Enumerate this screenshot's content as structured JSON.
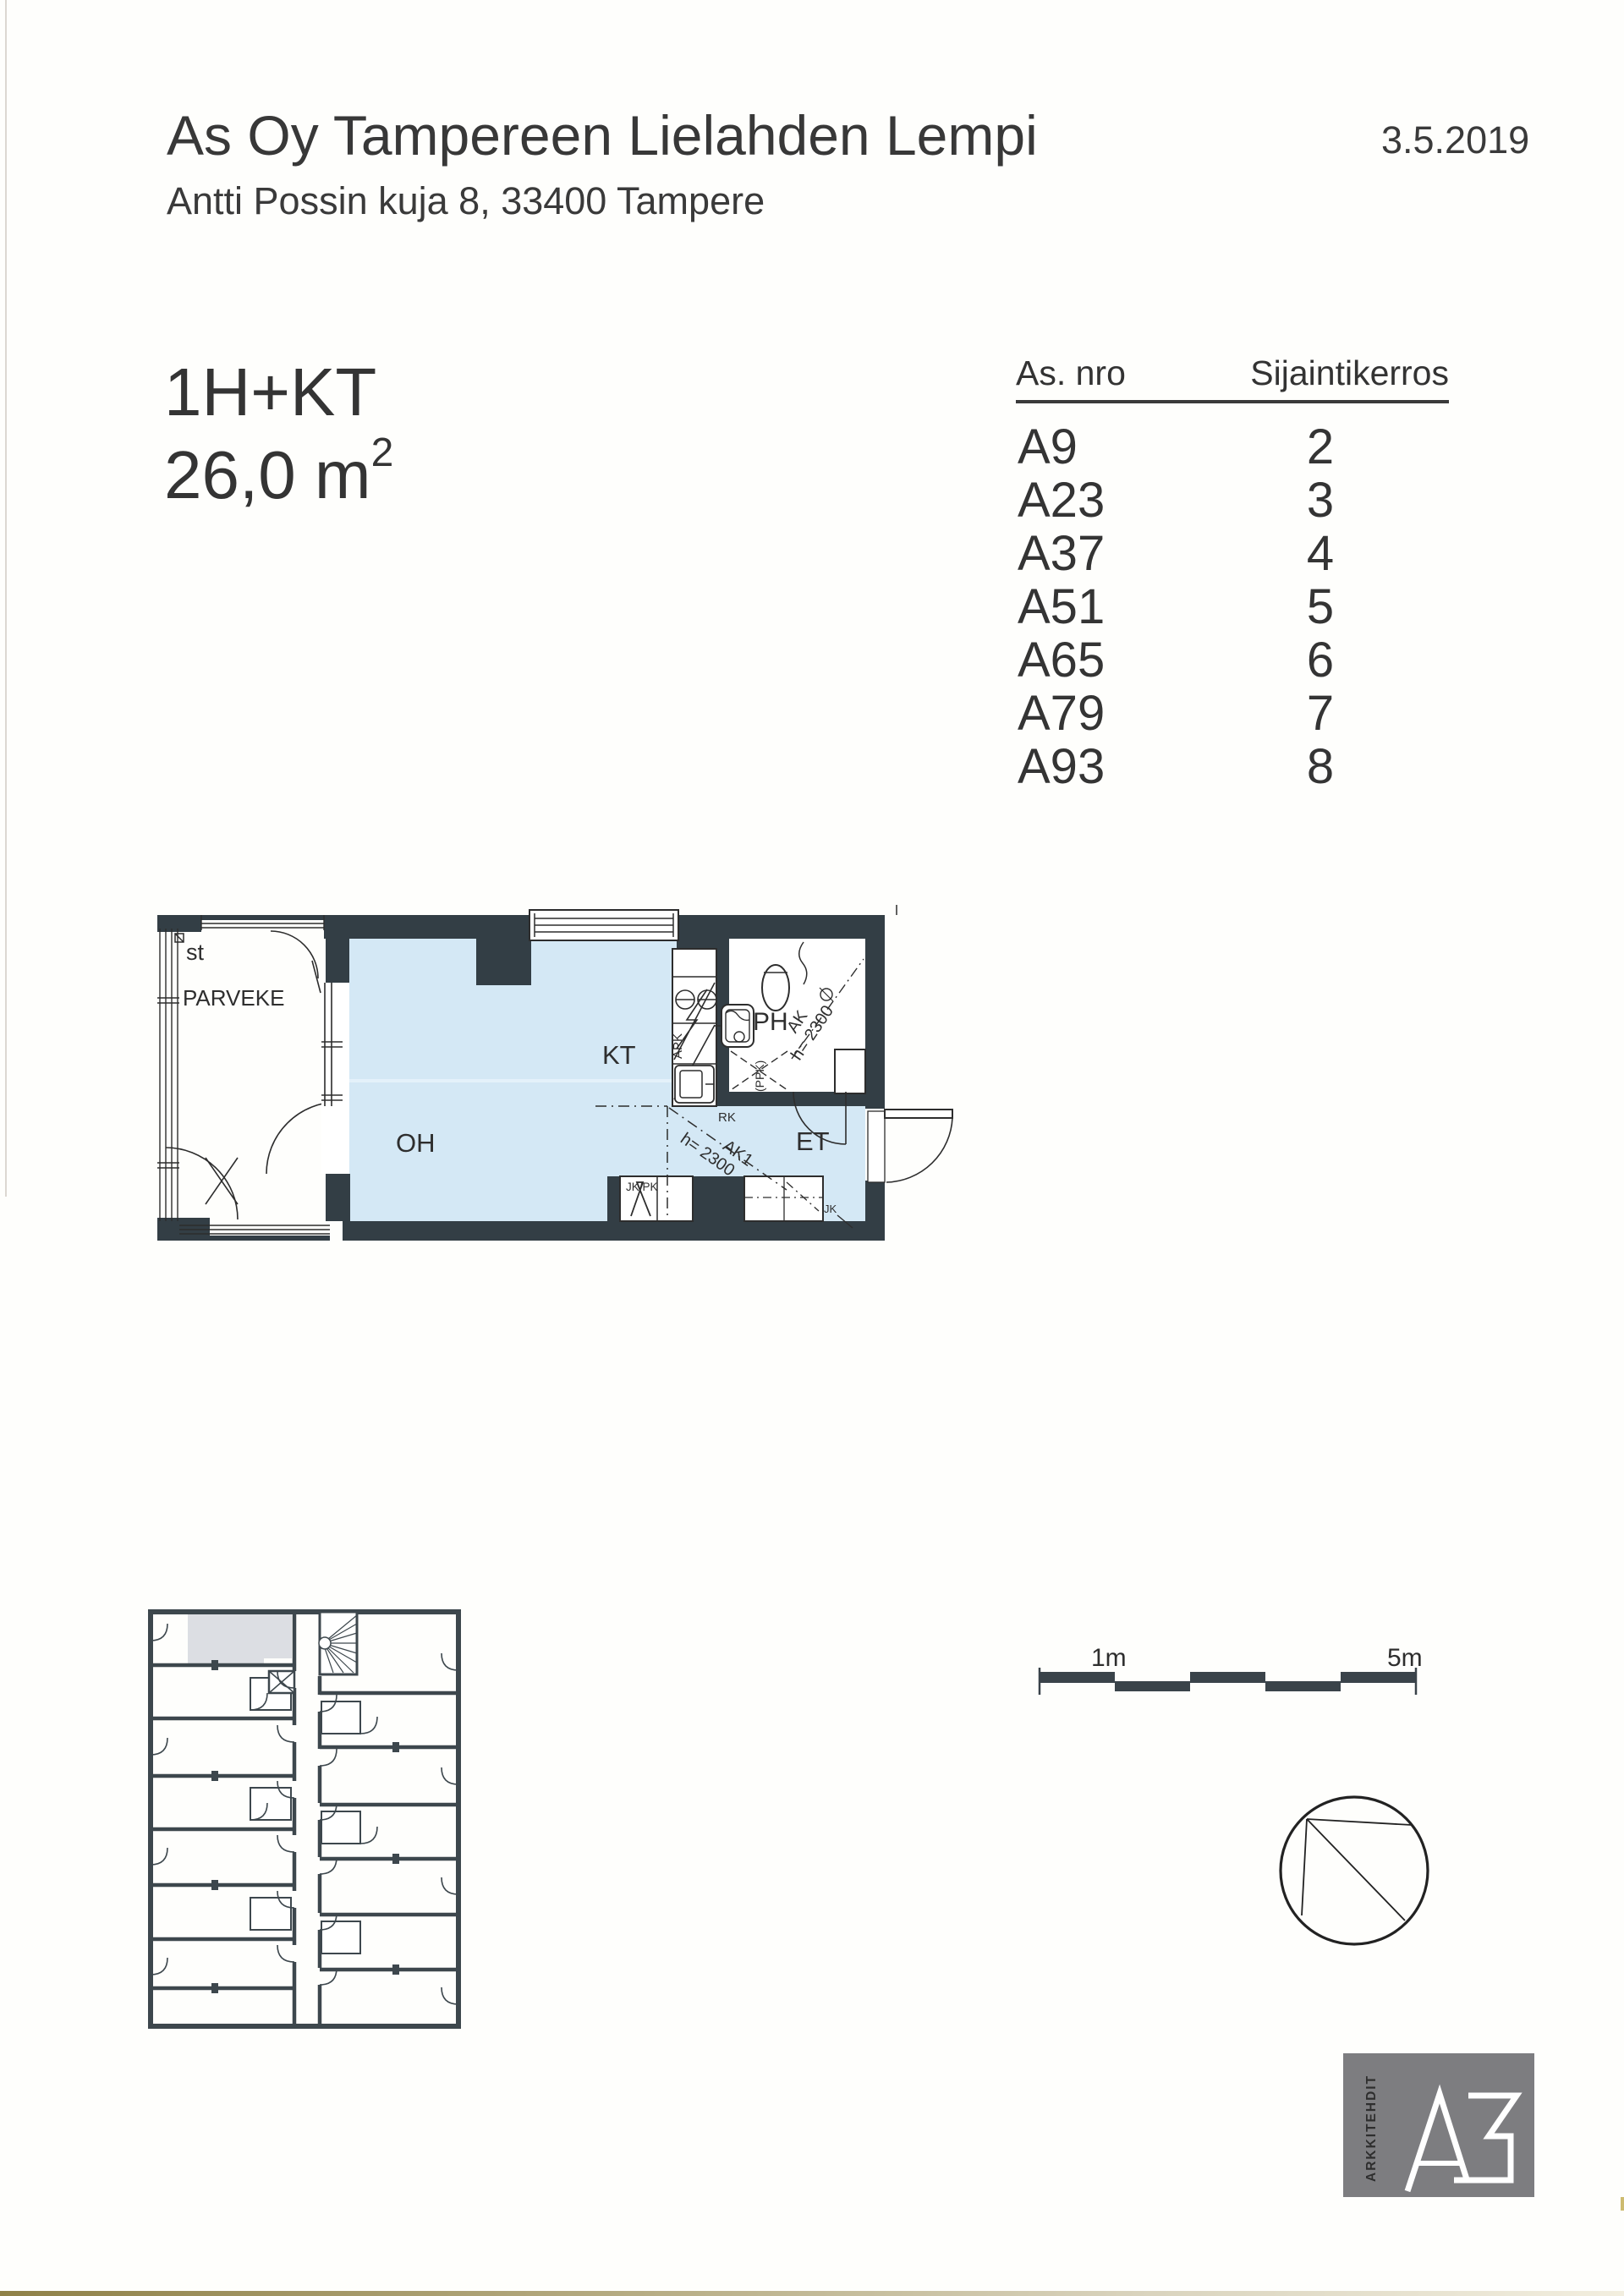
{
  "document": {
    "title": "As Oy Tampereen Lielahden Lempi",
    "date": "3.5.2019",
    "address": "Antti Possin kuja 8, 33400 Tampere"
  },
  "apartment": {
    "type": "1H+KT",
    "area": "26,0 m",
    "area_superscript": "2"
  },
  "location_table": {
    "columns": [
      "As. nro",
      "Sijaintikerros"
    ],
    "rows": [
      {
        "apartment": "A9",
        "floor": "2"
      },
      {
        "apartment": "A23",
        "floor": "3"
      },
      {
        "apartment": "A37",
        "floor": "4"
      },
      {
        "apartment": "A51",
        "floor": "5"
      },
      {
        "apartment": "A65",
        "floor": "6"
      },
      {
        "apartment": "A79",
        "floor": "7"
      },
      {
        "apartment": "A93",
        "floor": "8"
      }
    ]
  },
  "floor_plan": {
    "room_labels": {
      "balcony_structure": "st",
      "balcony": "PARVEKE",
      "kitchen": "KT",
      "living_room": "OH",
      "bathroom": "PH",
      "entry": "ET"
    },
    "annotations": {
      "rk": "RK",
      "apk": "APK",
      "ppk": "(PPK)",
      "jk_pk": "JK/PK",
      "jk": "JK",
      "ak1": "AK1",
      "ak1_height": "h= 2300",
      "ak": "AK",
      "ak_height": "h= 2300"
    }
  },
  "scale_bar": {
    "start_label": "1m",
    "end_label": "5m"
  },
  "logo": {
    "vertical_text": "ARKKITEHDIT",
    "mark": "A3"
  },
  "colors": {
    "wall_dark": "#333e45",
    "overview_wall": "#3d474d",
    "floor_fill": "#d4e8f5",
    "highlight_unit": "#dcdee3",
    "logo_background": "#7d7d80",
    "scan_edge": "#8f8148"
  }
}
